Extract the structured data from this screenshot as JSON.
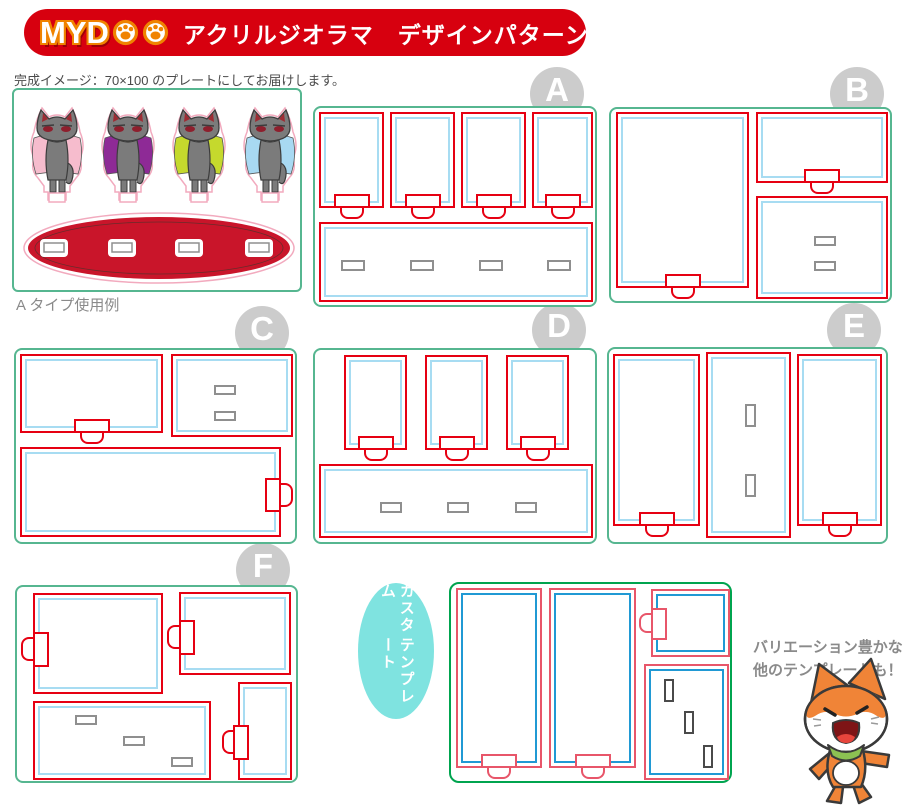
{
  "header": {
    "logo": "MYDOO",
    "logo_letters": "MYD",
    "title": "アクリルジオラマ　デザインパターン"
  },
  "sample": {
    "caption": "完成イメージ：70×100 のプレートにしてお届けします。",
    "label": "A タイプ使用例"
  },
  "templates": [
    {
      "letter": "A"
    },
    {
      "letter": "B"
    },
    {
      "letter": "C"
    },
    {
      "letter": "D"
    },
    {
      "letter": "E"
    },
    {
      "letter": "F"
    }
  ],
  "custom_bubble": {
    "line1": "カスタム",
    "line2": "テンプレート"
  },
  "footer_note": {
    "line1": "バリエーション豊かな",
    "line2": "他のテンプレートも！"
  },
  "colors": {
    "banner_red": "#d7000f",
    "logo_outline_orange": "#f08300",
    "plate_green": "#56b690",
    "cut_red": "#e60012",
    "inner_cyan": "#a7dcf2",
    "slot_gray": "#8f8f8f",
    "badge_gray": "#cccccc",
    "custom_green": "#00a44f",
    "custom_red": "#e8566a",
    "custom_blue": "#2099d4",
    "custom_slot": "#4a4a4a",
    "bubble_teal": "#7fe3e0",
    "oval_red": "#c9152a",
    "cut_pink": "#f2aabe",
    "cape_1": "#f6bccd",
    "cape_2": "#8e2a96",
    "cape_3": "#c5d92d",
    "cape_4": "#a8d9f2",
    "cat_gray": "#7b7b7b",
    "mascot_orange": "#f08437",
    "mascot_scarf_green": "#8cc152",
    "note_gray": "#8a8a8a"
  }
}
